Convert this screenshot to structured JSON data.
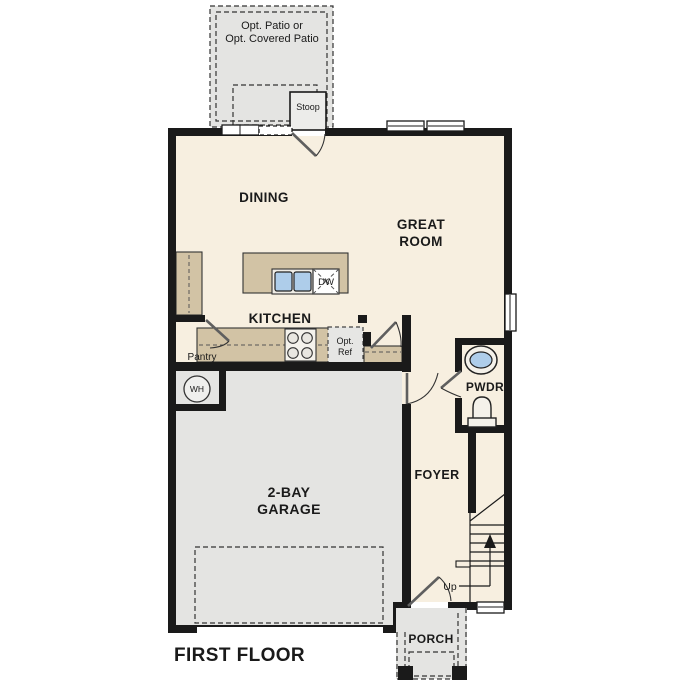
{
  "plan": {
    "title": "FIRST FLOOR",
    "rooms": {
      "patio_line1": "Opt. Patio or",
      "patio_line2": "Opt. Covered Patio",
      "stoop": "Stoop",
      "dining": "DINING",
      "great_room_line1": "GREAT",
      "great_room_line2": "ROOM",
      "kitchen": "KITCHEN",
      "pantry": "Pantry",
      "garage_line1": "2-BAY",
      "garage_line2": "GARAGE",
      "foyer": "FOYER",
      "powder_room": "PWDR",
      "porch": "PORCH"
    },
    "fixtures": {
      "dishwasher": "DW",
      "opt_ref_line1": "Opt.",
      "opt_ref_line2": "Ref",
      "water_heater": "WH",
      "stairs_direction": "Up"
    },
    "colors": {
      "wall": "#1a1a1a",
      "interior_floor": "#f7efe0",
      "cabinet_tan": "#d2c3a5",
      "exterior_concrete": "#e4e4e2",
      "sink_blue": "#aecdea",
      "background": "#ffffff"
    }
  }
}
